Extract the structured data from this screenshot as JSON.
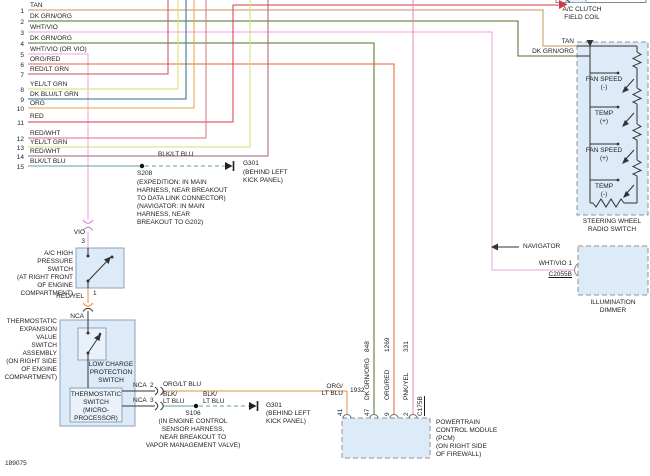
{
  "colors": {
    "tan": "#c9935f",
    "dk_grn_org": "#4e7226",
    "wht_vio": "#efa3da",
    "org_red": "#e8623a",
    "red_lt_grn": "#d14a58",
    "yel_lt_grn": "#cfe26e",
    "dk_blu_lt_grn": "#2e6f85",
    "org": "#e5a33f",
    "red": "#d6394b",
    "red_wht": "#d4717f",
    "red_wht_2": "#b05a7a",
    "blk_lt_blu": "#5f9dad",
    "vio": "#e39ad8",
    "vio_conn": "#cf74c4",
    "red_yel": "#e09148",
    "org_lt_blu": "#e69240",
    "pnk_yel": "#f083b5",
    "black_wire": "#333333",
    "box_fill": "#ddeaf7",
    "inner_fill": "#e9f2fb",
    "box_stroke": "#8fa3b8",
    "dash_stroke": "#909090",
    "ground": "#222222",
    "conn_stroke": "#888888"
  },
  "doc_number": "189075",
  "circuits": [
    {
      "n": "1",
      "label": "TAN"
    },
    {
      "n": "2",
      "label": "DK GRN/ORG"
    },
    {
      "n": "3",
      "label": "WHT/VIO"
    },
    {
      "n": "4",
      "label": "DK GRN/ORG"
    },
    {
      "n": "5",
      "label": "WHT/VIO (OR VIO)"
    },
    {
      "n": "6",
      "label": "ORG/RED"
    },
    {
      "n": "7",
      "label": "RED/LT GRN"
    },
    {
      "n": "8",
      "label": "YEL/LT GRN"
    },
    {
      "n": "9",
      "label": "DK BLU/LT GRN"
    },
    {
      "n": "10",
      "label": "ORG"
    },
    {
      "n": "11",
      "label": "RED"
    },
    {
      "n": "12",
      "label": "RED/WHT"
    },
    {
      "n": "13",
      "label": "YEL/LT GRN"
    },
    {
      "n": "14",
      "label": "RED/WHT"
    },
    {
      "n": "15",
      "label": "BLK/LT BLU"
    }
  ],
  "s208": {
    "wire": "BLK/LT BLU",
    "name": "S208",
    "note": [
      "(EXPEDITION: IN MAIN",
      "HARNESS, NEAR BREAKOUT",
      "TO DATA LINK CONNECTOR)",
      "(NAVIGATOR: IN MAIN",
      "HARNESS, NEAR",
      "BREAKOUT TO G202)"
    ],
    "ground": "G301",
    "ground_note": [
      "(BEHIND LEFT",
      "KICK PANEL)"
    ]
  },
  "ac_clutch": {
    "line1": "A/C CLUTCH",
    "line2": "FIELD COIL"
  },
  "radio_switch": {
    "wire1": "TAN",
    "wire2": "DK GRN/ORG",
    "rungs": [
      {
        "l1": "FAN SPEED",
        "l2": "(-)"
      },
      {
        "l1": "TEMP",
        "l2": "(+)"
      },
      {
        "l1": "FAN SPEED",
        "l2": "(+)"
      },
      {
        "l1": "TEMP",
        "l2": "(-)"
      }
    ],
    "cap1": "STEERING WHEEL",
    "cap2": "RADIO SWITCH"
  },
  "navigator": "NAVIGATOR",
  "illum": {
    "wire": "WHT/VIO 1",
    "conn": "C2055B",
    "cap1": "ILLUMINATION",
    "cap2": "DIMMER"
  },
  "hp_switch": {
    "wire_in": "VIO",
    "pin_in": "3",
    "note": [
      "A/C HIGH",
      "PRESSURE",
      "SWITCH",
      "(AT RIGHT FRONT",
      "OF ENGINE",
      "COMPARTMENT)"
    ],
    "pin_out": "1",
    "wire_out": "RED/YEL",
    "nca": "NCA"
  },
  "tev": {
    "note": [
      "THERMOSTATIC",
      "EXPANSION",
      "VALUE",
      "SWITCH",
      "ASSEMBLY",
      "(ON RIGHT SIDE",
      "OF ENGINE",
      "COMPARTMENT)"
    ],
    "low_charge": [
      "LOW CHARGE",
      "PROTECTION",
      "SWITCH"
    ],
    "micro": [
      "THERMOSTATIC",
      "SWITCH",
      "(MICRO-",
      "PROCESSOR)"
    ],
    "out1": "NCA  2",
    "out2": "NCA  3",
    "out1_wire": "ORG/LT BLU",
    "out2_wire1": "BLK/",
    "out2_wire2": "LT BLU"
  },
  "s106": {
    "name": "S106",
    "note": [
      "(IN ENGINE CONTROL",
      "SENSOR HARNESS,",
      "NEAR BREAKOUT TO",
      "VAPOR MANAGEMENT VALVE)"
    ],
    "ground": "G301",
    "ground_note": [
      "(BEHIND LEFT",
      "KICK PANEL)"
    ]
  },
  "pcm": {
    "cap": [
      "POWERTRAIN",
      "CONTROL MODULE",
      "(PCM)",
      "(ON RIGHT SIDE",
      "OF FIREWALL)"
    ],
    "conn": "C175B",
    "pin41": {
      "pin": "41",
      "circuit": "1932",
      "wire1": "ORG/",
      "wire2": "LT BLU"
    },
    "pin47": {
      "pin": "47",
      "circuit": "848",
      "wire": "DK GRN/ORG"
    },
    "pin9": {
      "pin": "9",
      "circuit": "1269",
      "wire": "ORG/RED"
    },
    "pin2": {
      "pin": "2",
      "circuit": "331",
      "wire": "PNK/YEL"
    }
  }
}
